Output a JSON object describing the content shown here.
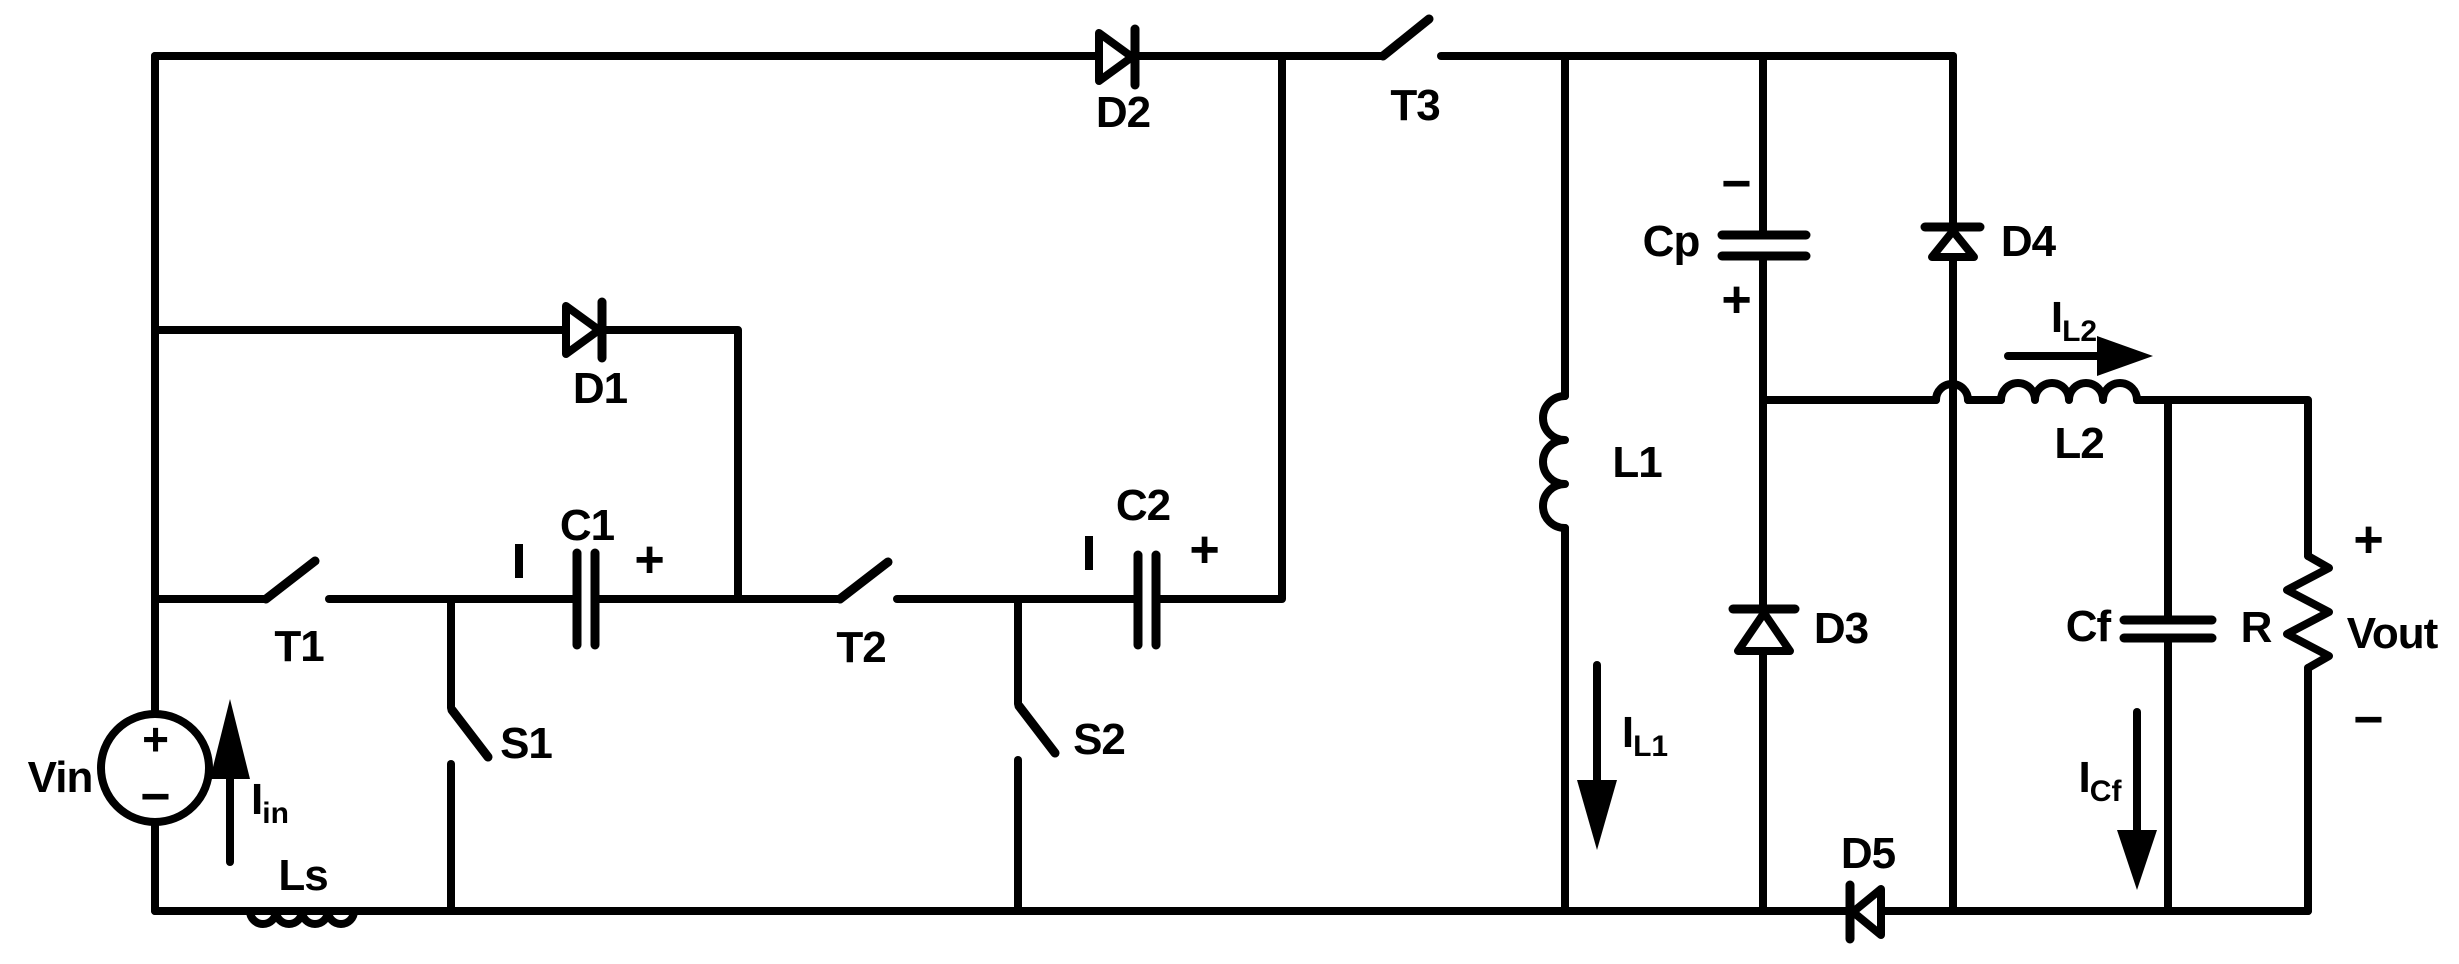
{
  "colors": {
    "ink": "#000000",
    "paper": "#ffffff"
  },
  "source": {
    "name": "Vin",
    "plus": "+",
    "minus": "−"
  },
  "currents": {
    "iin": {
      "base": "I",
      "sub": "in"
    },
    "il1": {
      "base": "I",
      "sub": "L1"
    },
    "il2": {
      "base": "I",
      "sub": "L2"
    },
    "icf": {
      "base": "I",
      "sub": "Cf"
    }
  },
  "switches": {
    "t1": "T1",
    "t2": "T2",
    "t3": "T3",
    "s1": "S1",
    "s2": "S2"
  },
  "diodes": {
    "d1": "D1",
    "d2": "D2",
    "d3": "D3",
    "d4": "D4",
    "d5": "D5"
  },
  "capacitors": {
    "c1": {
      "name": "C1",
      "neg_mark": "|",
      "pos_mark": "+"
    },
    "c2": {
      "name": "C2",
      "neg_mark": "|",
      "pos_mark": "+"
    },
    "cp": {
      "name": "Cp",
      "neg_mark": "−",
      "pos_mark": "+"
    },
    "cf": {
      "name": "Cf"
    }
  },
  "inductors": {
    "ls": "Ls",
    "l1": "L1",
    "l2": "L2"
  },
  "load": {
    "resistor": "R",
    "output": {
      "name": "Vout",
      "plus": "+",
      "minus": "−"
    }
  }
}
